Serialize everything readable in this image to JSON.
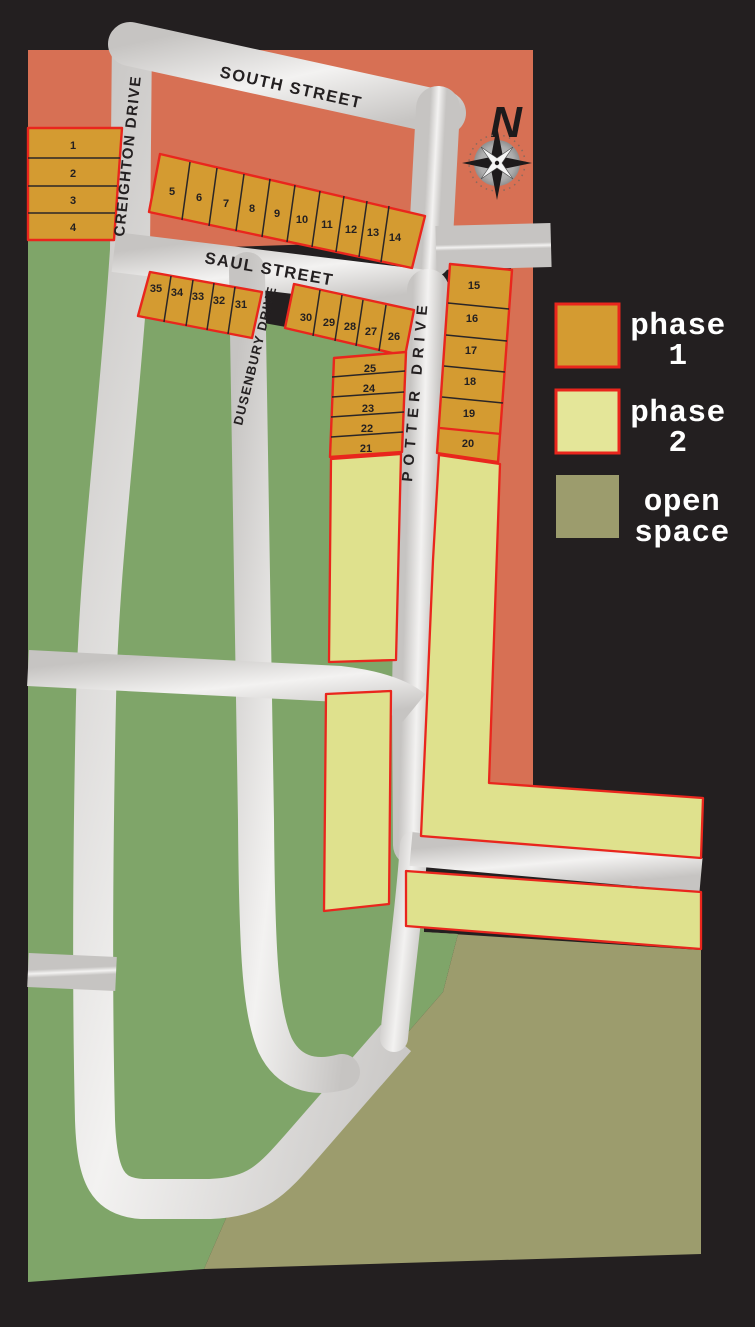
{
  "map": {
    "streets": {
      "south": "SOUTH STREET",
      "creighton": "CREIGHTON DRIVE",
      "saul": "SAUL STREET",
      "dusenbury": "DUSENBURY DRIVE",
      "potter": "POTTER DRIVE"
    },
    "compass": "N",
    "lot_numbers": [
      "1",
      "2",
      "3",
      "4",
      "5",
      "6",
      "7",
      "8",
      "9",
      "10",
      "11",
      "12",
      "13",
      "14",
      "15",
      "16",
      "17",
      "18",
      "19",
      "20",
      "21",
      "22",
      "23",
      "24",
      "25",
      "26",
      "27",
      "28",
      "29",
      "30",
      "31",
      "32",
      "33",
      "34",
      "35"
    ]
  },
  "legend": {
    "items": [
      {
        "id": "phase-1",
        "line1": "phase",
        "line2": "1",
        "color": "#D49B31",
        "border": "#E9261D"
      },
      {
        "id": "phase-2",
        "line1": "phase",
        "line2": "2",
        "color": "#E4E699",
        "border": "#E9261D"
      },
      {
        "id": "open-space",
        "line1": "open",
        "line2": "space",
        "color": "#9C9C6D",
        "border": "none"
      }
    ]
  },
  "colors": {
    "background": "#231F20",
    "existing_area": "#D77054",
    "phase1_lot": "#D49B31",
    "phase2_area": "#DFE18D",
    "open_space": "#9C9C6D",
    "greenspace": "#7FA569",
    "road_light": "#F2F1F0",
    "road_dark": "#C9C7C5",
    "outline_red": "#E9261D"
  }
}
